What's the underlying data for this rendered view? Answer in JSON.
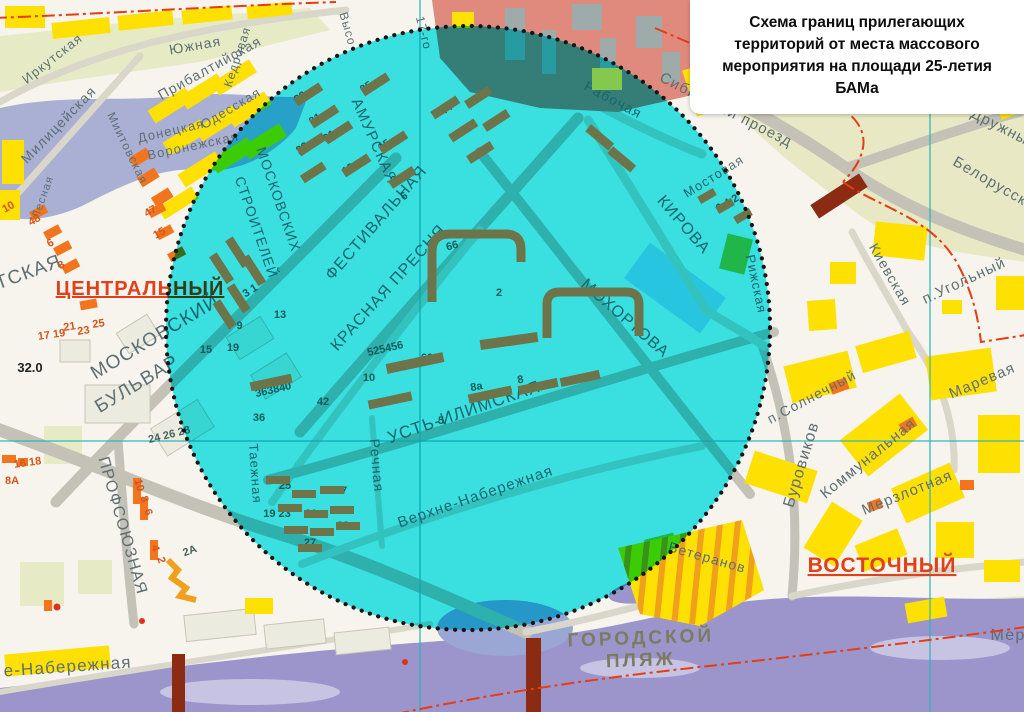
{
  "title": {
    "text": "Схема границ прилегающих территорий от места массового мероприятия на площади 25-летия БАМа"
  },
  "districts": [
    {
      "t": "ЦЕНТРАЛЬНЫЙ",
      "x": 140,
      "y": 295,
      "r": 0,
      "s": 20
    },
    {
      "t": "ВОСТОЧНЫЙ",
      "x": 882,
      "y": 572,
      "r": 0,
      "s": 21
    }
  ],
  "places": [
    {
      "t": "ГОРОДСКОЙ",
      "x": 641,
      "y": 644,
      "r": -2,
      "s": 19
    },
    {
      "t": "ПЛЯЖ",
      "x": 641,
      "y": 666,
      "r": -2,
      "s": 19
    }
  ],
  "elevation_mark": {
    "t": "32.0",
    "x": 30,
    "y": 372,
    "r": 0,
    "s": 13
  },
  "streets": [
    {
      "t": "Иркутская",
      "x": 55,
      "y": 62,
      "r": -38,
      "s": 13
    },
    {
      "t": "Южная",
      "x": 196,
      "y": 50,
      "r": -10,
      "s": 14
    },
    {
      "t": "Прибалтийская",
      "x": 212,
      "y": 72,
      "r": -29,
      "s": 14
    },
    {
      "t": "Кедровая",
      "x": 241,
      "y": 58,
      "r": -72,
      "s": 12
    },
    {
      "t": "Одесская",
      "x": 233,
      "y": 112,
      "r": -31,
      "s": 13
    },
    {
      "t": "Донецкая",
      "x": 172,
      "y": 135,
      "r": -13,
      "s": 13
    },
    {
      "t": "Воронежская",
      "x": 194,
      "y": 150,
      "r": -12,
      "s": 13
    },
    {
      "t": "Милицейская",
      "x": 62,
      "y": 128,
      "r": -46,
      "s": 14
    },
    {
      "t": "Миитовская",
      "x": 124,
      "y": 150,
      "r": 64,
      "s": 12
    },
    {
      "t": "Лесная",
      "x": 46,
      "y": 198,
      "r": -70,
      "s": 11
    },
    {
      "t": "ИРКУТСКАЯ",
      "x": 5,
      "y": 287,
      "r": -20,
      "s": 19
    },
    {
      "t": "МОСКОВСКИЙ",
      "x": 158,
      "y": 342,
      "r": -31,
      "s": 19
    },
    {
      "t": "БУЛЬВАР",
      "x": 140,
      "y": 389,
      "r": -31,
      "s": 19
    },
    {
      "t": "ПРОФСОЮЗНАЯ",
      "x": 118,
      "y": 527,
      "r": 74,
      "s": 16
    },
    {
      "t": "е-Набережная",
      "x": 68,
      "y": 672,
      "r": -4,
      "s": 17
    },
    {
      "t": "Таежная",
      "x": 251,
      "y": 474,
      "r": 86,
      "s": 13
    },
    {
      "t": "АМУРСКАЯ",
      "x": 370,
      "y": 143,
      "r": 66,
      "s": 15
    },
    {
      "t": "ФЕСТИВАЛЬНАЯ",
      "x": 380,
      "y": 226,
      "r": -49,
      "s": 16
    },
    {
      "t": "КРАСНАЯ ПРЕСНЯ",
      "x": 392,
      "y": 291,
      "r": -48,
      "s": 16
    },
    {
      "t": "МОСКОВСКИХ",
      "x": 274,
      "y": 201,
      "r": 71,
      "s": 14
    },
    {
      "t": "СТРОИТЕЛЕЙ",
      "x": 252,
      "y": 229,
      "r": 71,
      "s": 14
    },
    {
      "t": "УСТЬ-ИЛИМСКАЯ",
      "x": 466,
      "y": 417,
      "r": -19,
      "s": 17
    },
    {
      "t": "Речная",
      "x": 372,
      "y": 466,
      "r": 85,
      "s": 14
    },
    {
      "t": "Верхне-Набережная",
      "x": 477,
      "y": 501,
      "r": -19,
      "s": 15
    },
    {
      "t": "МОХОРТОВА",
      "x": 622,
      "y": 322,
      "r": 41,
      "s": 16
    },
    {
      "t": "КИРОВА",
      "x": 680,
      "y": 228,
      "r": 49,
      "s": 16
    },
    {
      "t": "Мостовая",
      "x": 716,
      "y": 180,
      "r": -32,
      "s": 13
    },
    {
      "t": "Рабочая",
      "x": 611,
      "y": 104,
      "r": 28,
      "s": 14
    },
    {
      "t": "Сибирский проезд",
      "x": 724,
      "y": 114,
      "r": 27,
      "s": 15
    },
    {
      "t": "Рижская",
      "x": 752,
      "y": 285,
      "r": 78,
      "s": 13
    },
    {
      "t": "п.Солнечный",
      "x": 814,
      "y": 401,
      "r": -28,
      "s": 14
    },
    {
      "t": "Буровиков",
      "x": 806,
      "y": 466,
      "r": -73,
      "s": 16
    },
    {
      "t": "Коммунальная",
      "x": 871,
      "y": 462,
      "r": -39,
      "s": 15
    },
    {
      "t": "Мерзлотная",
      "x": 909,
      "y": 497,
      "r": -22,
      "s": 15
    },
    {
      "t": "Маревая",
      "x": 984,
      "y": 385,
      "r": -23,
      "s": 15
    },
    {
      "t": "Киевская",
      "x": 886,
      "y": 277,
      "r": 60,
      "s": 14
    },
    {
      "t": "п.Угольный",
      "x": 966,
      "y": 285,
      "r": -25,
      "s": 15
    },
    {
      "t": "Белорусская",
      "x": 996,
      "y": 190,
      "r": 30,
      "s": 15
    },
    {
      "t": "Дружный",
      "x": 1002,
      "y": 133,
      "r": 27,
      "s": 15
    },
    {
      "t": "Ветеранов",
      "x": 706,
      "y": 562,
      "r": 16,
      "s": 14
    },
    {
      "t": "Высо",
      "x": 344,
      "y": 30,
      "r": 74,
      "s": 12
    },
    {
      "t": "17-го",
      "x": 420,
      "y": 34,
      "r": 76,
      "s": 12
    },
    {
      "t": "Мер",
      "x": 1008,
      "y": 640,
      "r": 0,
      "s": 16
    }
  ],
  "numbers": [
    {
      "t": "10",
      "x": 10,
      "y": 210,
      "r": -30,
      "c": "o"
    },
    {
      "t": "48",
      "x": 36,
      "y": 223,
      "r": -30,
      "c": "o"
    },
    {
      "t": "6",
      "x": 52,
      "y": 246,
      "r": -30,
      "c": "o"
    },
    {
      "t": "8",
      "x": 63,
      "y": 268,
      "r": -30,
      "c": "o"
    },
    {
      "t": "47",
      "x": 152,
      "y": 214,
      "r": -30,
      "c": "o"
    },
    {
      "t": "15",
      "x": 161,
      "y": 236,
      "r": -30,
      "c": "o"
    },
    {
      "t": "17 19",
      "x": 52,
      "y": 338,
      "r": -8,
      "c": "o"
    },
    {
      "t": "21",
      "x": 70,
      "y": 330,
      "r": -8,
      "c": "o"
    },
    {
      "t": "23",
      "x": 84,
      "y": 334,
      "r": -8,
      "c": "o"
    },
    {
      "t": "25",
      "x": 99,
      "y": 327,
      "r": -8,
      "c": "o"
    },
    {
      "t": "16 18",
      "x": 28,
      "y": 466,
      "r": -8,
      "c": "o"
    },
    {
      "t": "8А",
      "x": 12,
      "y": 484,
      "r": 0,
      "c": "o"
    },
    {
      "t": "24 26 28",
      "x": 170,
      "y": 438,
      "r": -14
    },
    {
      "t": "10",
      "x": 136,
      "y": 486,
      "r": 75,
      "c": "o"
    },
    {
      "t": "8",
      "x": 141,
      "y": 500,
      "r": 75,
      "c": "o"
    },
    {
      "t": "6",
      "x": 145,
      "y": 513,
      "r": 75,
      "c": "o"
    },
    {
      "t": "4",
      "x": 152,
      "y": 549,
      "r": 75,
      "c": "o"
    },
    {
      "t": "2",
      "x": 158,
      "y": 561,
      "r": 75,
      "c": "o"
    },
    {
      "t": "2А",
      "x": 191,
      "y": 554,
      "r": -20
    },
    {
      "t": "39",
      "x": 302,
      "y": 100,
      "r": -33
    },
    {
      "t": "31",
      "x": 317,
      "y": 122,
      "r": -33
    },
    {
      "t": "23",
      "x": 304,
      "y": 151,
      "r": -33
    },
    {
      "t": "21",
      "x": 331,
      "y": 139,
      "r": -33
    },
    {
      "t": "25",
      "x": 368,
      "y": 90,
      "r": -33
    },
    {
      "t": "15",
      "x": 386,
      "y": 148,
      "r": -33
    },
    {
      "t": "13",
      "x": 350,
      "y": 172,
      "r": -33
    },
    {
      "t": "8",
      "x": 396,
      "y": 183,
      "r": -33
    },
    {
      "t": "6",
      "x": 406,
      "y": 199,
      "r": -33
    },
    {
      "t": "5 3 1",
      "x": 248,
      "y": 296,
      "r": -32
    },
    {
      "t": "7 9",
      "x": 235,
      "y": 329,
      "r": 0
    },
    {
      "t": "13",
      "x": 280,
      "y": 318,
      "r": 0
    },
    {
      "t": "15",
      "x": 206,
      "y": 353,
      "r": 0
    },
    {
      "t": "19",
      "x": 233,
      "y": 351,
      "r": 0
    },
    {
      "t": "363840",
      "x": 274,
      "y": 393,
      "r": -13
    },
    {
      "t": "42",
      "x": 323,
      "y": 405,
      "r": 0
    },
    {
      "t": "36",
      "x": 259,
      "y": 421,
      "r": 0
    },
    {
      "t": "525456",
      "x": 386,
      "y": 352,
      "r": -13
    },
    {
      "t": "10",
      "x": 369,
      "y": 381,
      "r": 0
    },
    {
      "t": "60",
      "x": 427,
      "y": 361,
      "r": 0
    },
    {
      "t": "66",
      "x": 453,
      "y": 249,
      "r": -15
    },
    {
      "t": "2",
      "x": 499,
      "y": 296,
      "r": 0
    },
    {
      "t": "8а",
      "x": 477,
      "y": 390,
      "r": -10
    },
    {
      "t": "8",
      "x": 521,
      "y": 383,
      "r": -10
    },
    {
      "t": "5",
      "x": 441,
      "y": 424,
      "r": 0
    },
    {
      "t": "25",
      "x": 285,
      "y": 489,
      "r": 0
    },
    {
      "t": "37",
      "x": 341,
      "y": 494,
      "r": 0
    },
    {
      "t": "19 23",
      "x": 277,
      "y": 517,
      "r": 0
    },
    {
      "t": "21",
      "x": 311,
      "y": 517,
      "r": 0
    },
    {
      "t": "33",
      "x": 343,
      "y": 529,
      "r": 0
    },
    {
      "t": "27",
      "x": 310,
      "y": 546,
      "r": 0
    },
    {
      "t": "6 4 2",
      "x": 729,
      "y": 206,
      "r": -30
    },
    {
      "t": "44",
      "x": 448,
      "y": 112,
      "r": -33
    },
    {
      "t": "48",
      "x": 462,
      "y": 136,
      "r": -33
    }
  ],
  "colors": {
    "circle_fill": "#3ce9f2",
    "boundary_dots": "#151515",
    "street_label": "#5d6f74",
    "number_label": "#47635e",
    "number_label_alt": "#d4541a",
    "district_label": "#e2401a",
    "place_label": "#7b7b62",
    "road": "#c4c1b6",
    "road_minor": "#d9d6ca",
    "water_river": "#9b95cb",
    "water_lake": "#a9b0d3",
    "zone_green": "#e8e9c4",
    "zone_light": "#e6ebc6",
    "sand": "#eeeddc",
    "building_yellow": "#ffe003",
    "building_orange": "#f2751d",
    "building_inside": "#6e744a",
    "industrial": "#e08a7e",
    "pool": "#a6d8ec",
    "rail": "#8b2c12",
    "grid_line": "#2ab4bc",
    "admin_line": "#e63c14",
    "background": "#f6f4ec"
  }
}
